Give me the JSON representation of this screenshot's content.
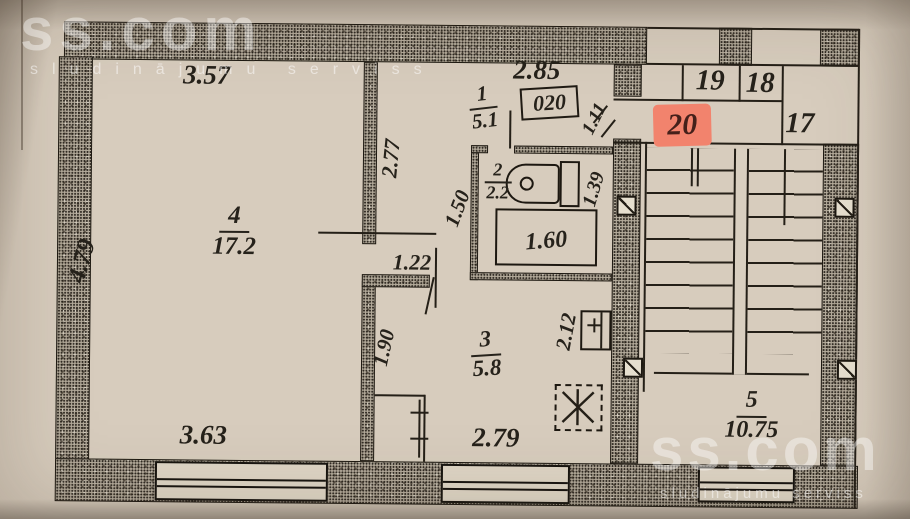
{
  "watermarks": {
    "brand": "ss.com",
    "tagline": "sludinājumu serviss"
  },
  "plan": {
    "unit_box_label": "020",
    "highlighted_unit": "20",
    "neighbor_units": {
      "n19": "19",
      "n18": "18",
      "n17": "17"
    },
    "rooms": {
      "hall": {
        "number": "1",
        "area": "5.1"
      },
      "bathroom": {
        "number": "2",
        "area": "2.2"
      },
      "kitchen": {
        "number": "3",
        "area": "5.8"
      },
      "living": {
        "number": "4",
        "area": "17.2"
      },
      "stairwell": {
        "number": "5",
        "area": "10.75"
      }
    },
    "dimensions": {
      "living_top": "3.57",
      "living_left": "4.79",
      "living_bottom": "3.63",
      "hall_top": "2.85",
      "hall_depth": "2.77",
      "entry_width": "1.11",
      "bath_left": "1.50",
      "bath_right": "1.39",
      "bathtub": "1.60",
      "corridor": "1.22",
      "kitchen_left": "1.90",
      "kitchen_right": "2.12",
      "kitchen_bottom": "2.79"
    },
    "colors": {
      "highlight": "#f2836d",
      "paper": "#d7ccbd",
      "ink": "#26221b"
    }
  }
}
